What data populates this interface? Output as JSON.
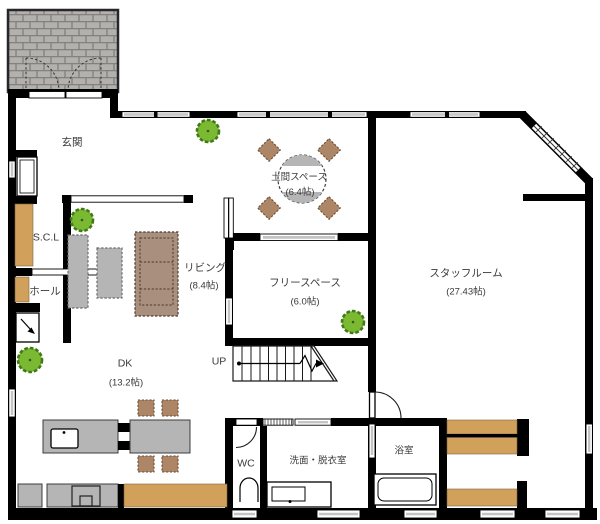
{
  "title": "1F floor plan",
  "colors": {
    "wall": "#000000",
    "brick": "#b3b1ad",
    "wood": "#d1a15c",
    "furniture_gray": "#b5b5b5",
    "sofa_brown": "#a98f7e",
    "chair_brown": "#ad8567",
    "plant_green": "#7cb932",
    "window_gray": "#c4c4c4",
    "label": "#3a3a3a"
  },
  "rooms": {
    "genkan": {
      "name": "玄関"
    },
    "doma": {
      "name": "土間スペース",
      "size": "(6.4帖)"
    },
    "living": {
      "name": "リビング",
      "size": "(8.4帖)"
    },
    "free_space": {
      "name": "フリースペース",
      "size": "(6.0帖)"
    },
    "staff_room": {
      "name": "スタッフルーム",
      "size": "(27.43帖)"
    },
    "scl": {
      "name": "S.C.L"
    },
    "hall": {
      "name": "ホール"
    },
    "dk": {
      "name": "DK",
      "size": "(13.2帖)"
    },
    "wc": {
      "name": "WC"
    },
    "washroom": {
      "name": "洗面・脱衣室"
    },
    "bath": {
      "name": "浴室"
    }
  },
  "stairs": {
    "label": "UP"
  }
}
